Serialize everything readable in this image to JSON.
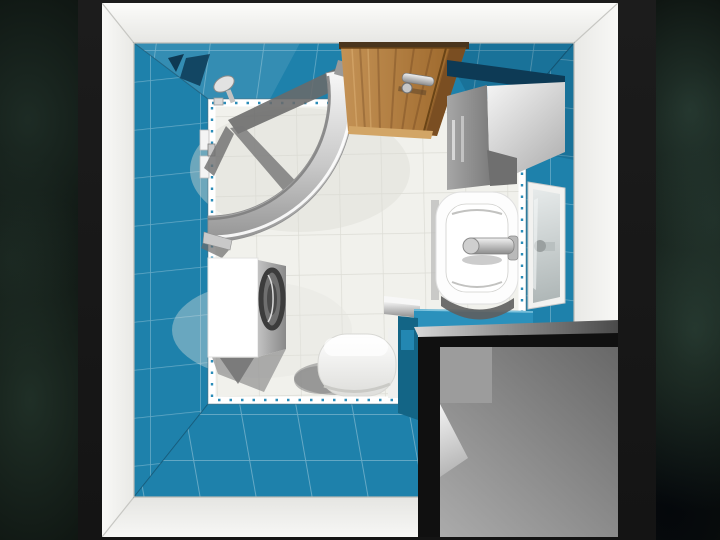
{
  "scene": {
    "description": "3D top-down rendering of a small bathroom design, shown as a framed picture over a dark mottled backdrop",
    "view": "top-down perspective",
    "room": "bathroom",
    "objects": [
      {
        "name": "corner-shower-enclosure",
        "material": "curved chrome/glass"
      },
      {
        "name": "shower-fixtures",
        "material": "chrome"
      },
      {
        "name": "entry-door",
        "material": "wood",
        "state": "closed, chrome handle"
      },
      {
        "name": "wall-cabinet",
        "material": "gray laminate"
      },
      {
        "name": "washbasin",
        "material": "white ceramic, chrome faucet"
      },
      {
        "name": "wall-mirror",
        "material": "white frame"
      },
      {
        "name": "washing-machine",
        "material": "white, round porthole door"
      },
      {
        "name": "toilet",
        "material": "white ceramic"
      },
      {
        "name": "vanity-counter-block",
        "material": "blue tile top, dark gray body"
      },
      {
        "name": "wall-tiles",
        "material": "blue ceramic"
      },
      {
        "name": "floor-tiles",
        "material": "white ceramic with dashed listello trim"
      }
    ]
  },
  "palette": {
    "background_dark": "#0b100d",
    "mat_black": "#1c1c1c",
    "photo_white": "#f3f3f1",
    "wall_blue": "#1e81ab",
    "wall_blue_light": "#2b91bc",
    "wall_blue_dark": "#136586",
    "wall_shadow_navy": "#0d3a55",
    "floor_white": "#f1f1ec",
    "floor_grout": "#dcdcd5",
    "trim_dash_blue": "#2a8cb8",
    "wood_light": "#c49255",
    "wood_dark": "#996428",
    "wood_edge": "#7a4e22",
    "chrome_light": "#f2f2f2",
    "chrome_dark": "#8c8c8c",
    "box_black": "#101010",
    "panel_gray": "#8a8a8a",
    "shadow_gray": "#6e6e6e",
    "fixture_white": "#ffffff"
  }
}
